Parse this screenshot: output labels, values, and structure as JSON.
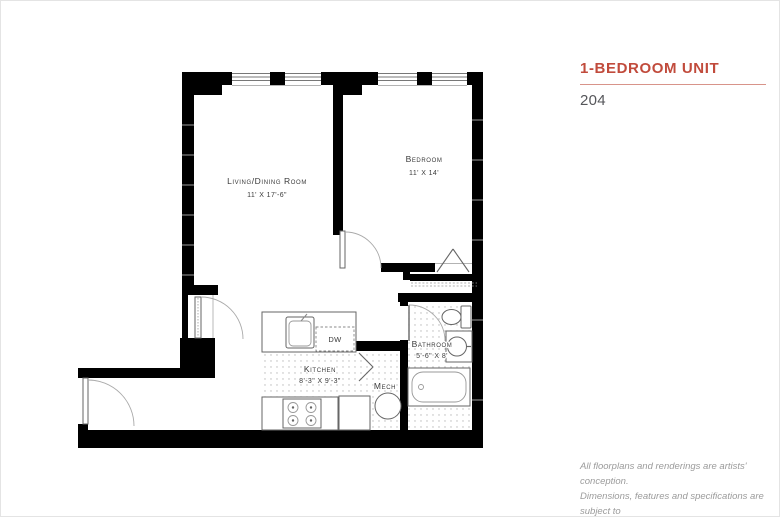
{
  "header": {
    "title": "1-BEDROOM UNIT",
    "unit_number": "204",
    "accent_color": "#c14b3c",
    "underline_color": "#d8948a"
  },
  "floorplan": {
    "rooms": {
      "living": {
        "name": "Living/Dining Room",
        "dims": "11' X 17'-6\""
      },
      "bedroom": {
        "name": "Bedroom",
        "dims": "11' X 14'"
      },
      "kitchen": {
        "name": "Kitchen",
        "dims": "8'-3\" X 9'-3\""
      },
      "bathroom": {
        "name": "Bathroom",
        "dims": "5'-6\" X 8'"
      },
      "mech": {
        "name": "Mech"
      },
      "dishwasher": {
        "abbr": "DW"
      }
    }
  },
  "disclaimer": {
    "lines": [
      "All floorplans and renderings are artists' conception.",
      "Dimensions, features and specifications are subject to",
      "change at the discretion of the builder."
    ]
  }
}
